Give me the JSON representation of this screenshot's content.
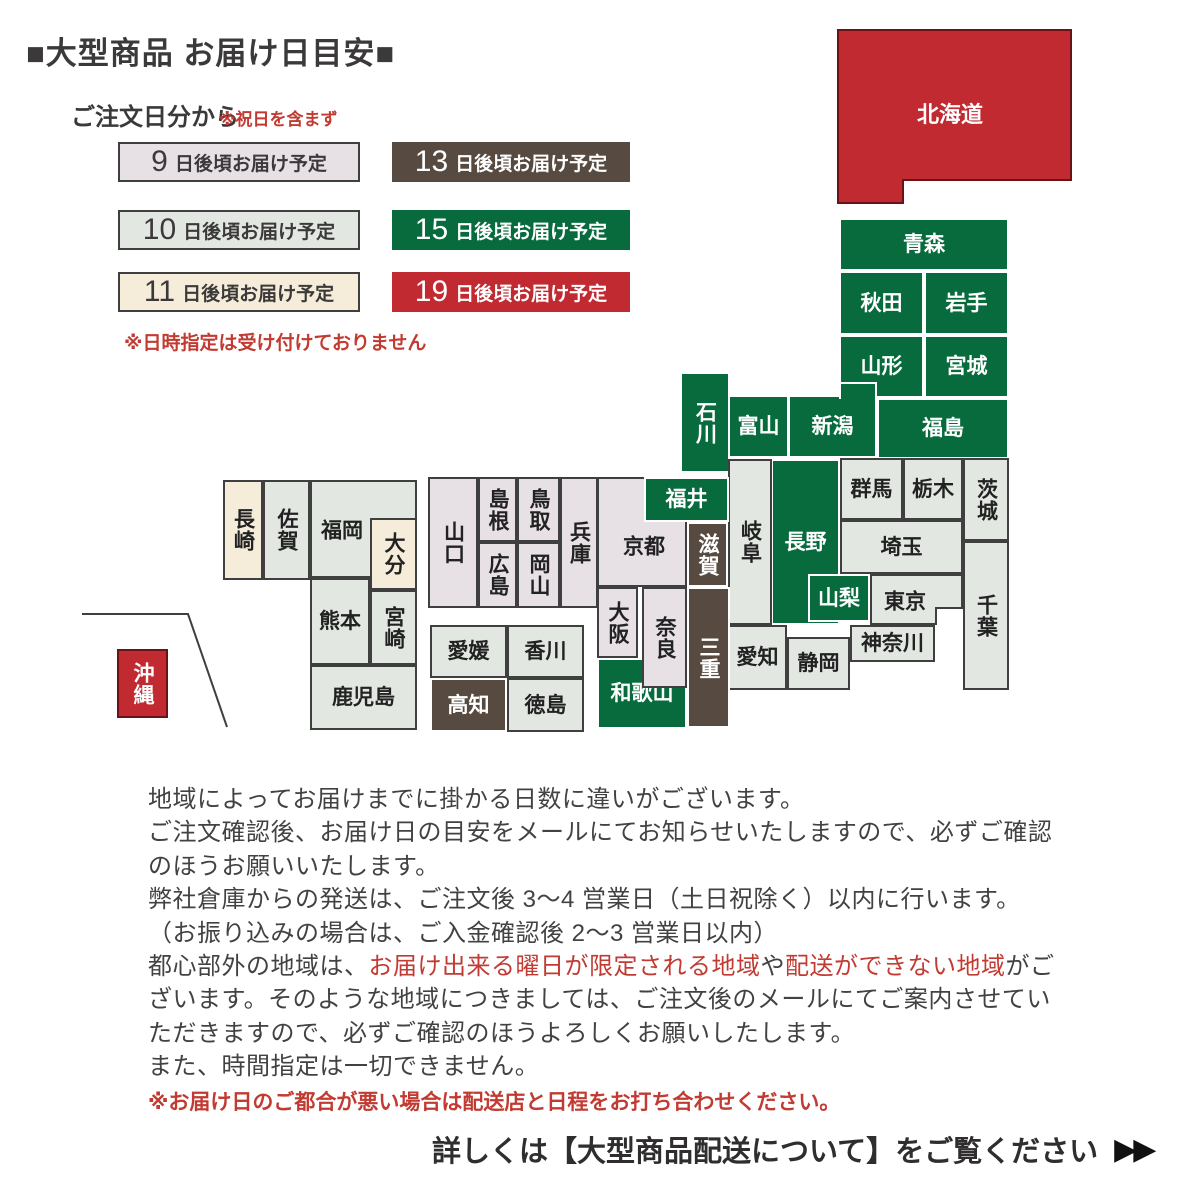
{
  "page": {
    "title": "■大型商品 お届け日目安■"
  },
  "legend": {
    "heading": "ご注文日分から",
    "holiday_note": "※祝日を含まず",
    "datetime_note": "※日時指定は受け付けておりません",
    "items": [
      {
        "id": "after-9-days",
        "num": "9",
        "suffix": "日後頃お届け予定",
        "category": "d9",
        "x": 118,
        "y": 142,
        "w": 242,
        "h": 40
      },
      {
        "id": "after-13-days",
        "num": "13",
        "suffix": "日後頃お届け予定",
        "category": "d13",
        "x": 392,
        "y": 142,
        "w": 238,
        "h": 40
      },
      {
        "id": "after-10-days",
        "num": "10",
        "suffix": "日後頃お届け予定",
        "category": "d10",
        "x": 118,
        "y": 210,
        "w": 242,
        "h": 40
      },
      {
        "id": "after-15-days",
        "num": "15",
        "suffix": "日後頃お届け予定",
        "category": "d15",
        "x": 392,
        "y": 210,
        "w": 238,
        "h": 40
      },
      {
        "id": "after-11-days",
        "num": "11",
        "suffix": "日後頃お届け予定",
        "category": "d11",
        "x": 118,
        "y": 272,
        "w": 242,
        "h": 40
      },
      {
        "id": "after-19-days",
        "num": "19",
        "suffix": "日後頃お届け予定",
        "category": "d19",
        "x": 392,
        "y": 272,
        "w": 238,
        "h": 40
      }
    ]
  },
  "colors": {
    "d9": {
      "bg": "#e7e1e6",
      "fg": "#222222",
      "border": "#3f3f3f"
    },
    "d10": {
      "bg": "#e2e8e1",
      "fg": "#222222",
      "border": "#3f3f3f"
    },
    "d11": {
      "bg": "#f5edda",
      "fg": "#222222",
      "border": "#3f3f3f"
    },
    "d13": {
      "bg": "#564a41",
      "fg": "#ffffff",
      "border": "#ffffff"
    },
    "d15": {
      "bg": "#086b3e",
      "fg": "#ffffff",
      "border": "#ffffff"
    },
    "d19": {
      "bg": "#c22a32",
      "fg": "#ffffff",
      "border": "#6b1216"
    }
  },
  "map": {
    "hokkaido": {
      "id": "hokkaido",
      "label": "北海道",
      "category": "d19",
      "polygon": "838,30 1071,30 1071,180 903,180 903,203 838,203",
      "label_x": 950,
      "label_y": 113
    },
    "okinawa_boundary": "82,614 188,614 227,727",
    "prefectures": [
      {
        "id": "kyoto",
        "label": "京都",
        "category": "d9",
        "x": 597,
        "y": 477,
        "w": 90,
        "h": 110,
        "lcy": 545
      },
      {
        "id": "fukuoka",
        "label": "福岡",
        "category": "d10",
        "x": 310,
        "y": 480,
        "w": 107,
        "h": 98,
        "lcx": 340,
        "lcy": 529
      },
      {
        "id": "wakayama",
        "label": "和歌山",
        "category": "d15",
        "x": 597,
        "y": 658,
        "w": 90,
        "h": 71
      },
      {
        "id": "nagano",
        "label": "長野",
        "category": "d15",
        "x": 771,
        "y": 459,
        "w": 69,
        "h": 166
      },
      {
        "id": "tokyo",
        "label": "東京",
        "category": "d10",
        "x": 870,
        "y": 574,
        "w": 93,
        "h": 51,
        "lcx": 903
      },
      {
        "id": "aomori",
        "label": "青森",
        "category": "d15",
        "x": 839,
        "y": 218,
        "w": 170,
        "h": 53
      },
      {
        "id": "akita",
        "label": "秋田",
        "category": "d15",
        "x": 839,
        "y": 271,
        "w": 85,
        "h": 64
      },
      {
        "id": "iwate",
        "label": "岩手",
        "category": "d15",
        "x": 924,
        "y": 271,
        "w": 85,
        "h": 64
      },
      {
        "id": "yamagata",
        "label": "山形",
        "category": "d15",
        "x": 839,
        "y": 335,
        "w": 85,
        "h": 63
      },
      {
        "id": "miyagi",
        "label": "宮城",
        "category": "d15",
        "x": 924,
        "y": 335,
        "w": 85,
        "h": 63
      },
      {
        "id": "fukushima",
        "label": "福島",
        "category": "d15",
        "x": 877,
        "y": 398,
        "w": 132,
        "h": 61
      },
      {
        "id": "ishikawa",
        "label": "石川",
        "category": "d15",
        "x": 680,
        "y": 372,
        "w": 50,
        "h": 101,
        "vert": true
      },
      {
        "id": "toyama",
        "label": "富山",
        "category": "d15",
        "x": 728,
        "y": 395,
        "w": 61,
        "h": 63
      },
      {
        "id": "niigata",
        "label": "新潟",
        "category": "d15",
        "x": 788,
        "y": 395,
        "w": 89,
        "h": 63
      },
      {
        "id": "gunma",
        "label": "群馬",
        "category": "d10",
        "x": 840,
        "y": 458,
        "w": 63,
        "h": 62
      },
      {
        "id": "tochigi",
        "label": "栃木",
        "category": "d10",
        "x": 903,
        "y": 458,
        "w": 60,
        "h": 62
      },
      {
        "id": "ibaraki",
        "label": "茨城",
        "category": "d10",
        "x": 963,
        "y": 458,
        "w": 46,
        "h": 83,
        "vert": true
      },
      {
        "id": "saitama",
        "label": "埼玉",
        "category": "d10",
        "x": 840,
        "y": 520,
        "w": 123,
        "h": 54
      },
      {
        "id": "chiba",
        "label": "千葉",
        "category": "d10",
        "x": 963,
        "y": 541,
        "w": 46,
        "h": 149,
        "vert": true
      },
      {
        "id": "kanagawa",
        "label": "神奈川",
        "category": "d10",
        "x": 850,
        "y": 625,
        "w": 85,
        "h": 37
      },
      {
        "id": "shizuoka",
        "label": "静岡",
        "category": "d10",
        "x": 787,
        "y": 637,
        "w": 63,
        "h": 53
      },
      {
        "id": "aichi",
        "label": "愛知",
        "category": "d10",
        "x": 728,
        "y": 625,
        "w": 59,
        "h": 65
      },
      {
        "id": "gifu",
        "label": "岐阜",
        "category": "d10",
        "x": 728,
        "y": 459,
        "w": 44,
        "h": 166,
        "vert": true
      },
      {
        "id": "hyogo",
        "label": "兵庫",
        "category": "d9",
        "x": 560,
        "y": 477,
        "w": 38,
        "h": 131,
        "vert": true
      },
      {
        "id": "yamaguchi",
        "label": "山口",
        "category": "d9",
        "x": 428,
        "y": 477,
        "w": 50,
        "h": 131,
        "vert": true
      },
      {
        "id": "shimane",
        "label": "島根",
        "category": "d9",
        "x": 478,
        "y": 477,
        "w": 39,
        "h": 65,
        "vert": true
      },
      {
        "id": "tottori",
        "label": "鳥取",
        "category": "d9",
        "x": 517,
        "y": 477,
        "w": 43,
        "h": 65,
        "vert": true
      },
      {
        "id": "hiroshima",
        "label": "広島",
        "category": "d9",
        "x": 478,
        "y": 542,
        "w": 39,
        "h": 66,
        "vert": true
      },
      {
        "id": "okayama",
        "label": "岡山",
        "category": "d9",
        "x": 517,
        "y": 542,
        "w": 43,
        "h": 66,
        "vert": true
      },
      {
        "id": "osaka",
        "label": "大阪",
        "category": "d9",
        "x": 597,
        "y": 587,
        "w": 41,
        "h": 71,
        "vert": true
      },
      {
        "id": "ehime",
        "label": "愛媛",
        "category": "d10",
        "x": 430,
        "y": 625,
        "w": 77,
        "h": 53
      },
      {
        "id": "kagawa",
        "label": "香川",
        "category": "d10",
        "x": 507,
        "y": 625,
        "w": 77,
        "h": 53
      },
      {
        "id": "kochi",
        "label": "高知",
        "category": "d13",
        "x": 430,
        "y": 678,
        "w": 77,
        "h": 54
      },
      {
        "id": "tokushima",
        "label": "徳島",
        "category": "d10",
        "x": 507,
        "y": 678,
        "w": 77,
        "h": 54
      },
      {
        "id": "nagasaki",
        "label": "長崎",
        "category": "d11",
        "x": 223,
        "y": 480,
        "w": 40,
        "h": 100,
        "vert": true
      },
      {
        "id": "saga",
        "label": "佐賀",
        "category": "d10",
        "x": 263,
        "y": 480,
        "w": 47,
        "h": 100,
        "vert": true
      },
      {
        "id": "kumamoto",
        "label": "熊本",
        "category": "d10",
        "x": 310,
        "y": 578,
        "w": 60,
        "h": 87
      },
      {
        "id": "miyazaki",
        "label": "宮崎",
        "category": "d10",
        "x": 370,
        "y": 590,
        "w": 47,
        "h": 75,
        "vert": true
      },
      {
        "id": "kagoshima",
        "label": "鹿児島",
        "category": "d10",
        "x": 310,
        "y": 665,
        "w": 107,
        "h": 65
      },
      {
        "id": "okinawa",
        "label": "沖縄",
        "category": "d19",
        "x": 117,
        "y": 649,
        "w": 51,
        "h": 69,
        "vert": true
      },
      {
        "id": "shiga",
        "label": "滋賀",
        "category": "d13",
        "x": 687,
        "y": 522,
        "w": 41,
        "h": 65,
        "vert": true
      },
      {
        "id": "mie",
        "label": "三重",
        "category": "d13",
        "x": 687,
        "y": 587,
        "w": 43,
        "h": 141,
        "vert": true
      },
      {
        "id": "fukui",
        "label": "福井",
        "category": "d15",
        "x": 644,
        "y": 477,
        "w": 85,
        "h": 45
      },
      {
        "id": "yamanashi",
        "label": "山梨",
        "category": "d15",
        "x": 808,
        "y": 574,
        "w": 62,
        "h": 48
      },
      {
        "id": "nara",
        "label": "奈良",
        "category": "d9",
        "x": 642,
        "y": 587,
        "w": 45,
        "h": 101,
        "vert": true
      },
      {
        "id": "oita",
        "label": "大分",
        "category": "d11",
        "x": 370,
        "y": 518,
        "w": 47,
        "h": 72,
        "vert": true
      }
    ],
    "extras": [
      {
        "id": "niigata-extension",
        "category": "d15",
        "x": 839,
        "y": 382,
        "w": 38,
        "h": 17,
        "borders": "ltr"
      },
      {
        "id": "tokyo-bay",
        "bg": "#ffffff",
        "border_color": "#3f3f3f",
        "x": 935,
        "y": 607,
        "w": 28,
        "h": 18,
        "borders": "lt"
      }
    ]
  },
  "notes": {
    "lines": [
      [
        {
          "t": "地域によってお届けまでに掛かる日数に違いがございます。"
        }
      ],
      [
        {
          "t": "ご注文確認後、お届け日の目安をメールにてお知らせいたしますので、必ずご確認"
        }
      ],
      [
        {
          "t": "のほうお願いいたします。"
        }
      ],
      [
        {
          "t": "弊社倉庫からの発送は、ご注文後 3〜4 営業日（土日祝除く）以内に行います。"
        }
      ],
      [
        {
          "t": "（お振り込みの場合は、ご入金確認後 2〜3 営業日以内）"
        }
      ],
      [
        {
          "t": "都心部外の地域は、"
        },
        {
          "t": "お届け出来る曜日が限定される地域",
          "red": true
        },
        {
          "t": "や"
        },
        {
          "t": "配送ができない地域",
          "red": true
        },
        {
          "t": "がご"
        }
      ],
      [
        {
          "t": "ざいます。そのような地域につきましては、ご注文後のメールにてご案内させてい"
        }
      ],
      [
        {
          "t": "ただきますので、必ずご確認のほうよろしくお願いしたします。"
        }
      ],
      [
        {
          "t": "また、時間指定は一切できません。"
        }
      ]
    ],
    "warning": "※お届け日のご都合が悪い場合は配送店と日程をお打ち合わせください。"
  },
  "footer": {
    "text": "詳しくは【大型商品配送について】をご覧ください",
    "arrows": "▶▶"
  }
}
